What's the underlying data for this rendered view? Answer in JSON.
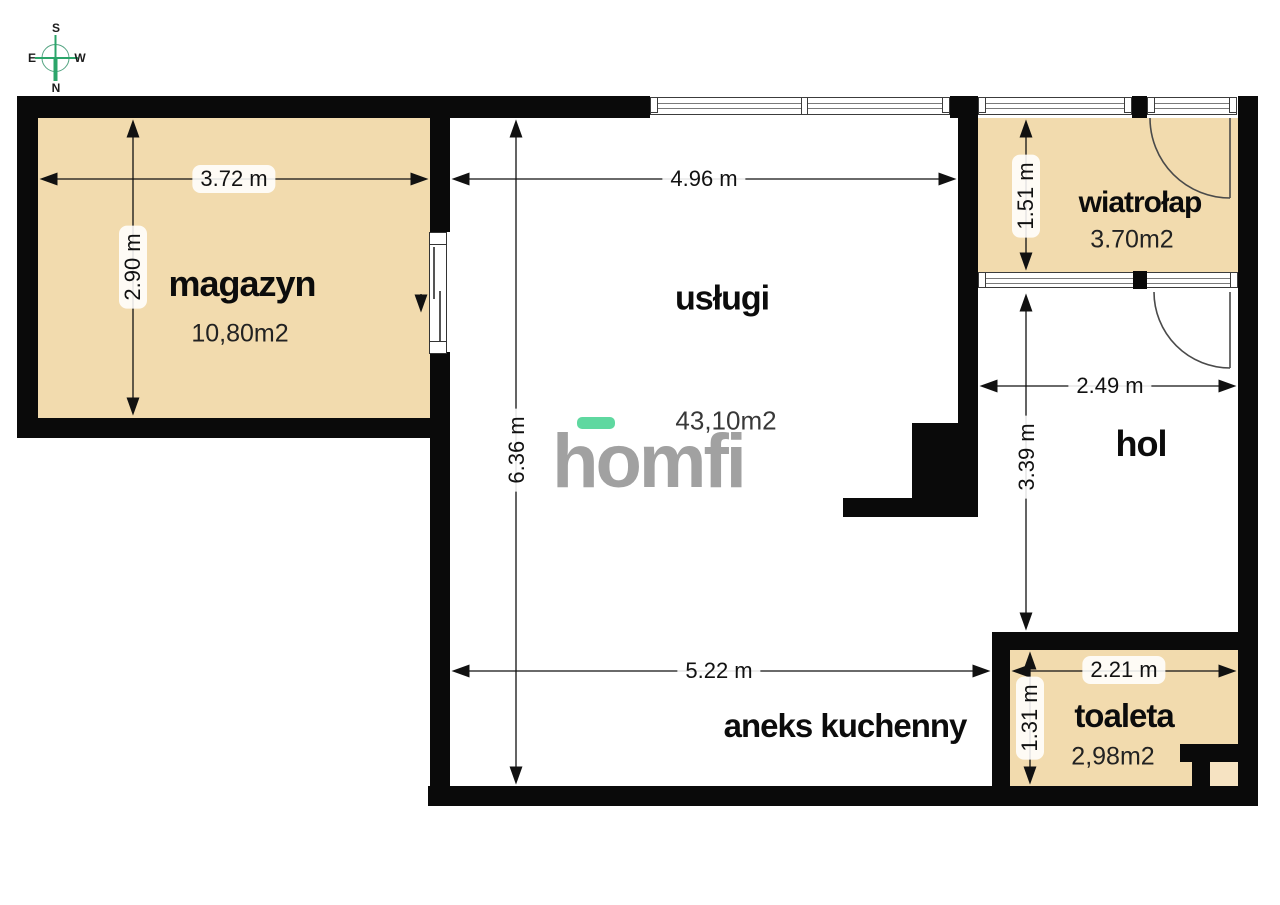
{
  "meta": {
    "type": "floor-plan"
  },
  "compass": {
    "north": "N",
    "south": "S",
    "east": "E",
    "west": "W"
  },
  "logo": {
    "text": "homfi",
    "accent_color": "#5fd8a0",
    "text_color": "#a1a1a1"
  },
  "rooms": {
    "magazyn": {
      "label": "magazyn",
      "area": "10,80m2"
    },
    "uslugi": {
      "label": "usługi",
      "area": "43,10m2"
    },
    "wiatrolap": {
      "label": "wiatrołap",
      "area": "3.70m2"
    },
    "hol": {
      "label": "hol"
    },
    "aneks_kuchenny": {
      "label": "aneks kuchenny"
    },
    "toaleta": {
      "label": "toaleta",
      "area": "2,98m2"
    }
  },
  "dimensions": {
    "magazyn_width": "3.72 m",
    "magazyn_depth": "2.90 m",
    "uslugi_width": "4.96 m",
    "uslugi_depth": "6.36 m",
    "wiatrolap_depth": "1.51 m",
    "hol_width": "2.49 m",
    "hol_depth": "3.39 m",
    "aneks_width": "5.22 m",
    "toaleta_width": "2.21 m",
    "toaleta_depth": "1.31 m"
  },
  "colors": {
    "room_fill": "#f2dbae",
    "duct_fill": "#f6e3c2",
    "wall": "#0a0a0a",
    "compass_green": "#2ba56a"
  }
}
